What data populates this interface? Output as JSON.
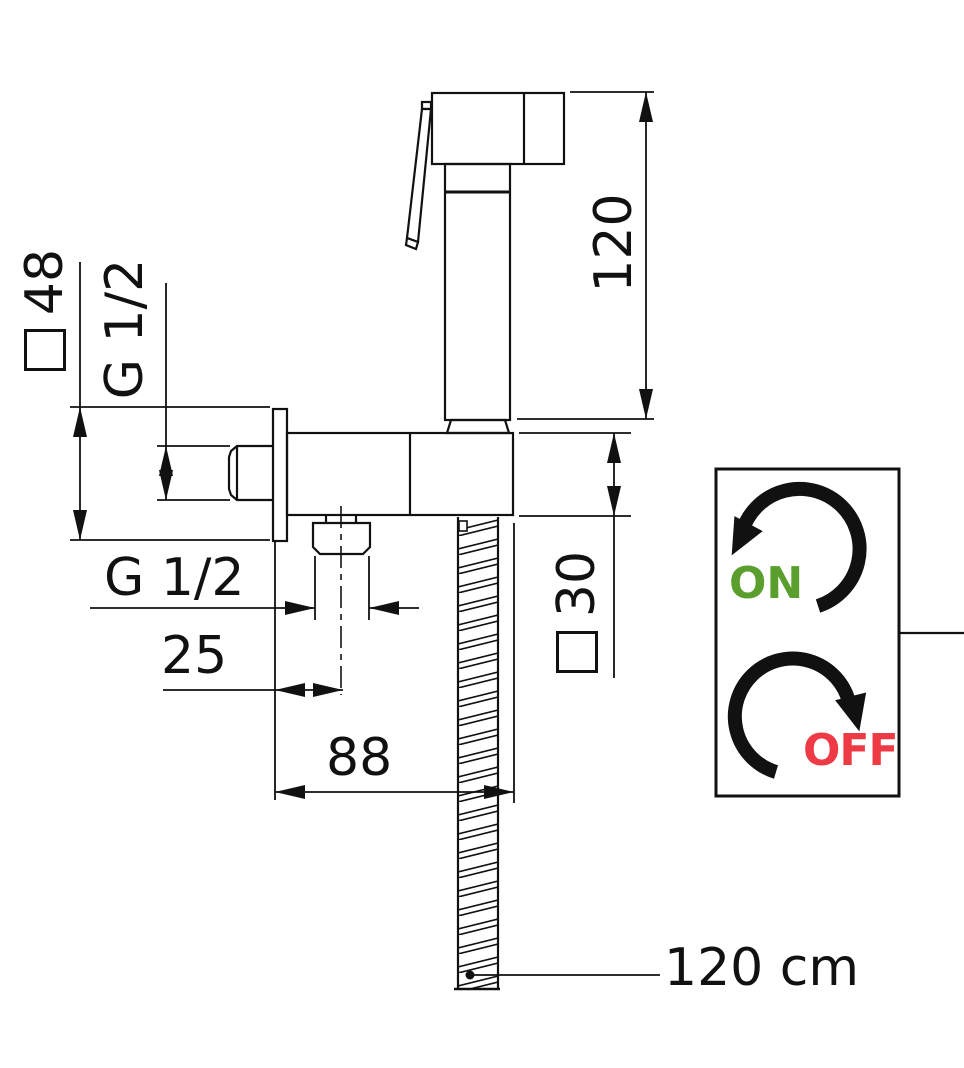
{
  "drawing": {
    "title": "bidet-shower-dimension-drawing",
    "dims": {
      "height": "120",
      "plate": "48",
      "thread_top": "G 1/2",
      "body": "30",
      "thread_bottom": "G 1/2",
      "offset": "25",
      "depth": "88",
      "hose_length": "120 cm"
    },
    "legend": {
      "on": "ON",
      "off": "OFF"
    },
    "colors": {
      "ink": "#111111",
      "on_green": "#5a9e2d",
      "off_red": "#ee3a45"
    }
  }
}
